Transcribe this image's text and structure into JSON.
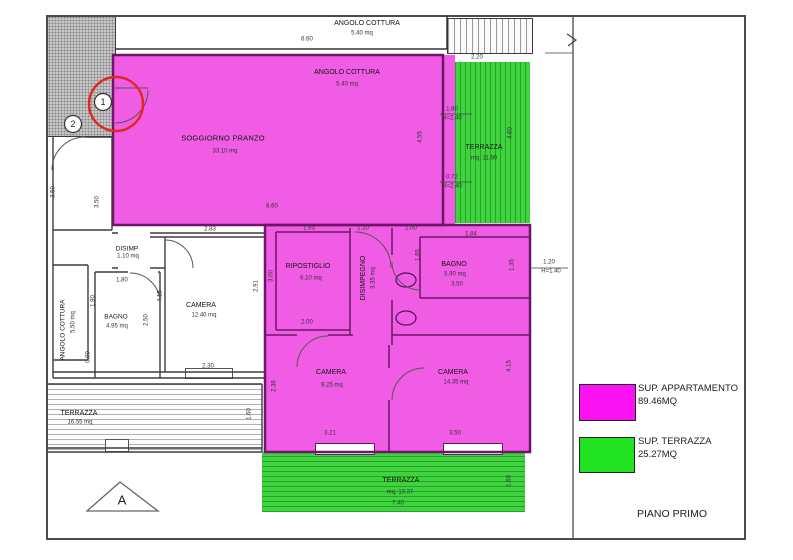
{
  "legend": {
    "apartment_label": "SUP. APPARTAMENTO",
    "apartment_value": "89.46MQ",
    "terrace_label": "SUP. TERRAZZA",
    "terrace_value": "25.27MQ",
    "floor_label": "PIANO PRIMO"
  },
  "colors": {
    "apartment": "#f05ce4",
    "terrace": "#3fd43f",
    "legend_apartment": "#fa12f2",
    "legend_terrace": "#21e321",
    "highlight_circle": "#e0281e"
  },
  "rooms": {
    "nb_kitchen": {
      "name": "ANGOLO COTTURA",
      "area": "5.40 mq"
    },
    "soggiorno": {
      "name": "SOGGIORNO PRANZO",
      "area": "33.10 mq"
    },
    "kitchen": {
      "name": "ANGOLO COTTURA",
      "area": "5.40 mq"
    },
    "terrace_right": {
      "name": "TERRAZZA",
      "area": "mq. 11.90"
    },
    "ripostiglio": {
      "name": "RIPOSTIGLIO",
      "area": "6.10 mq"
    },
    "disimpegno": {
      "name": "DISIMPEGNO",
      "area": "3.35 mq"
    },
    "bagno": {
      "name": "BAGNO",
      "area": "5.90 mq"
    },
    "camera1": {
      "name": "CAMERA",
      "area": "9.25 mq"
    },
    "camera2": {
      "name": "CAMERA",
      "area": "14.35 mq"
    },
    "terrace_bottom": {
      "name": "TERRAZZA",
      "area": "mq. 13.37"
    },
    "disimp": {
      "name": "DISIMP",
      "area": "1.10 mq"
    },
    "bagno_left": {
      "name": "BAGNO",
      "area": "4.95 mq"
    },
    "camera_left": {
      "name": "CAMERA",
      "area": "12.40 mq"
    },
    "kitchen_left": {
      "name": "ANGOLO COTTURA",
      "area": "5.50 mq"
    },
    "terrace_left": {
      "name": "TERRAZZA",
      "area": "16.55 mq"
    }
  },
  "dims": {
    "top_w": "6.60",
    "sog_w": "8.60",
    "sog_h": "4.55",
    "tr_w": "2.20",
    "tr_h": "4.60",
    "win1": "1.80",
    "win1h": "H=2.40",
    "win2": "0.72",
    "win2h": "H=2.40",
    "caml_top": "2.83",
    "rip_w": "1.93",
    "disw": "1.10",
    "bag_w1": "1.00",
    "bag_w2": "1.84",
    "bag_w": "3.50",
    "rip_b": "2.00",
    "rip_h": "3.00",
    "bag_hl": "1.85",
    "bag_hr": "1.35",
    "win3": "1.20",
    "win3h": "H=1.40",
    "cs_w": "3.21",
    "cl_w": "3.50",
    "cl_h": "4.15",
    "cs_h": "2.36",
    "tb_w": "7.40",
    "tb_h": "1.60",
    "bl_t": "1.80",
    "bl_l": "1.90",
    "bl_r": "2.50",
    "cl2_l": "4.15",
    "cl2_r": "2.91",
    "cl2_b": "2.30",
    "bl_b": "0.90",
    "corr": "3.50",
    "outer": "3.50",
    "tl_r": "1.60"
  },
  "markers": {
    "m1": "1",
    "m2": "2",
    "section": "A"
  }
}
